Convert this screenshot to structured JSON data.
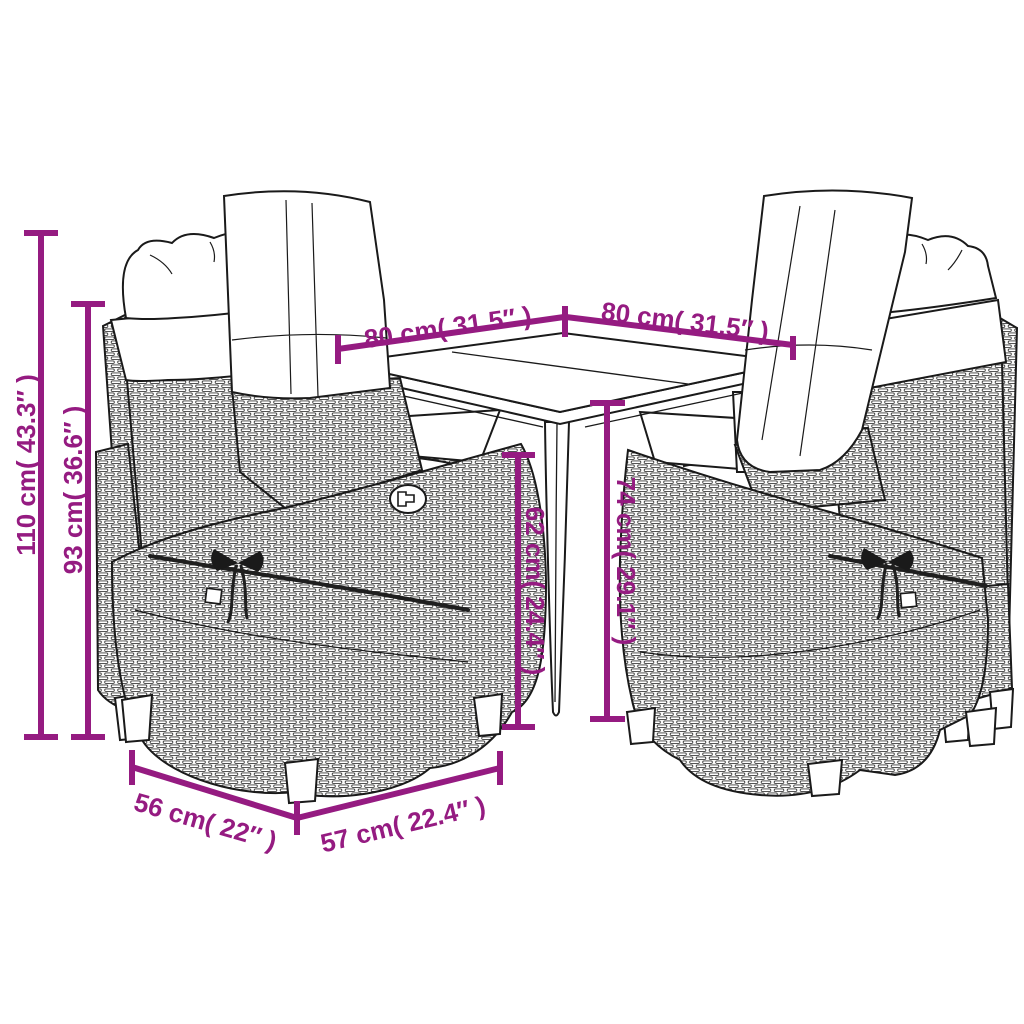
{
  "diagram": {
    "annotation_color": "#951b81",
    "line_color": "#1a1a1a",
    "background_color": "#ffffff",
    "scene": {
      "table": "square-garden-table",
      "chairs": "four-rattan-reclining-armchairs-with-cushions"
    },
    "dimensions": {
      "chair_total_height": {
        "label": "110 cm( 43.3″ )",
        "cm": 110,
        "inches": 43.3,
        "orientation": "vertical"
      },
      "chair_backrest_height": {
        "label": "93 cm( 36.6″ )",
        "cm": 93,
        "inches": 36.6,
        "orientation": "vertical"
      },
      "tabletop_side_left": {
        "label": "80 cm( 31.5″ )",
        "cm": 80,
        "inches": 31.5,
        "orientation": "diagonal"
      },
      "tabletop_side_right": {
        "label": "80 cm( 31.5″ )",
        "cm": 80,
        "inches": 31.5,
        "orientation": "diagonal"
      },
      "table_clearance_height": {
        "label": "62 cm( 24.4″ )",
        "cm": 62,
        "inches": 24.4,
        "orientation": "vertical"
      },
      "table_height": {
        "label": "74 cm( 29.1″ )",
        "cm": 74,
        "inches": 29.1,
        "orientation": "vertical"
      },
      "chair_width": {
        "label": "56 cm( 22″ )",
        "cm": 56,
        "inches": 22,
        "orientation": "diagonal"
      },
      "chair_depth": {
        "label": "57 cm( 22.4″ )",
        "cm": 57,
        "inches": 22.4,
        "orientation": "diagonal"
      }
    }
  }
}
